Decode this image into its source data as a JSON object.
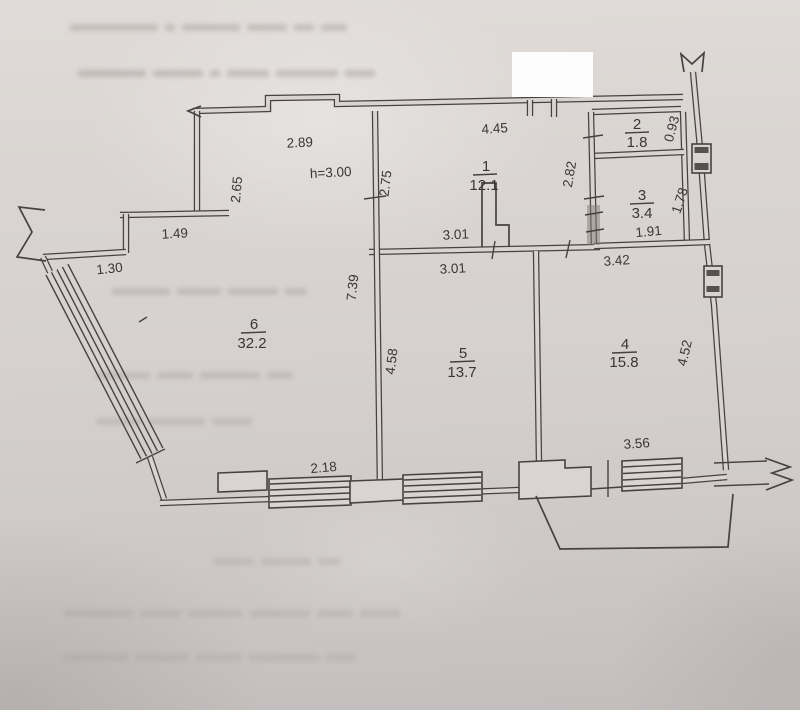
{
  "plan": {
    "rooms": [
      {
        "number": "1",
        "area": "12.1"
      },
      {
        "number": "2",
        "area": "1.8"
      },
      {
        "number": "3",
        "area": "3.4"
      },
      {
        "number": "4",
        "area": "15.8"
      },
      {
        "number": "5",
        "area": "13.7"
      },
      {
        "number": "6",
        "area": "32.2"
      }
    ],
    "ceiling_height_label": "h=3.00",
    "dimension_labels": {
      "room6_top_width": "2.89",
      "room6_upper_height": "2.65",
      "room1_top_width": "4.45",
      "room1_left_height": "2.75",
      "room1_right_height": "2.82",
      "room2_right_height": "0.93",
      "room3_right_height": "1.78",
      "room3_bottom_width": "1.91",
      "room1_bottom_width": "3.01",
      "room5_top_width": "3.01",
      "room4_top_width": "3.42",
      "hall_step_width": "1.49",
      "hall_left_width": "1.30",
      "room6_right_height": "7.39",
      "room5_left_height": "4.58",
      "room4_right_height": "4.52",
      "room6_window_width": "2.18",
      "room4_bottom_width": "3.56"
    },
    "colors": {
      "paper": "#d8d3d0",
      "ink": "#46423f",
      "redaction": "#fdfdfd"
    }
  }
}
